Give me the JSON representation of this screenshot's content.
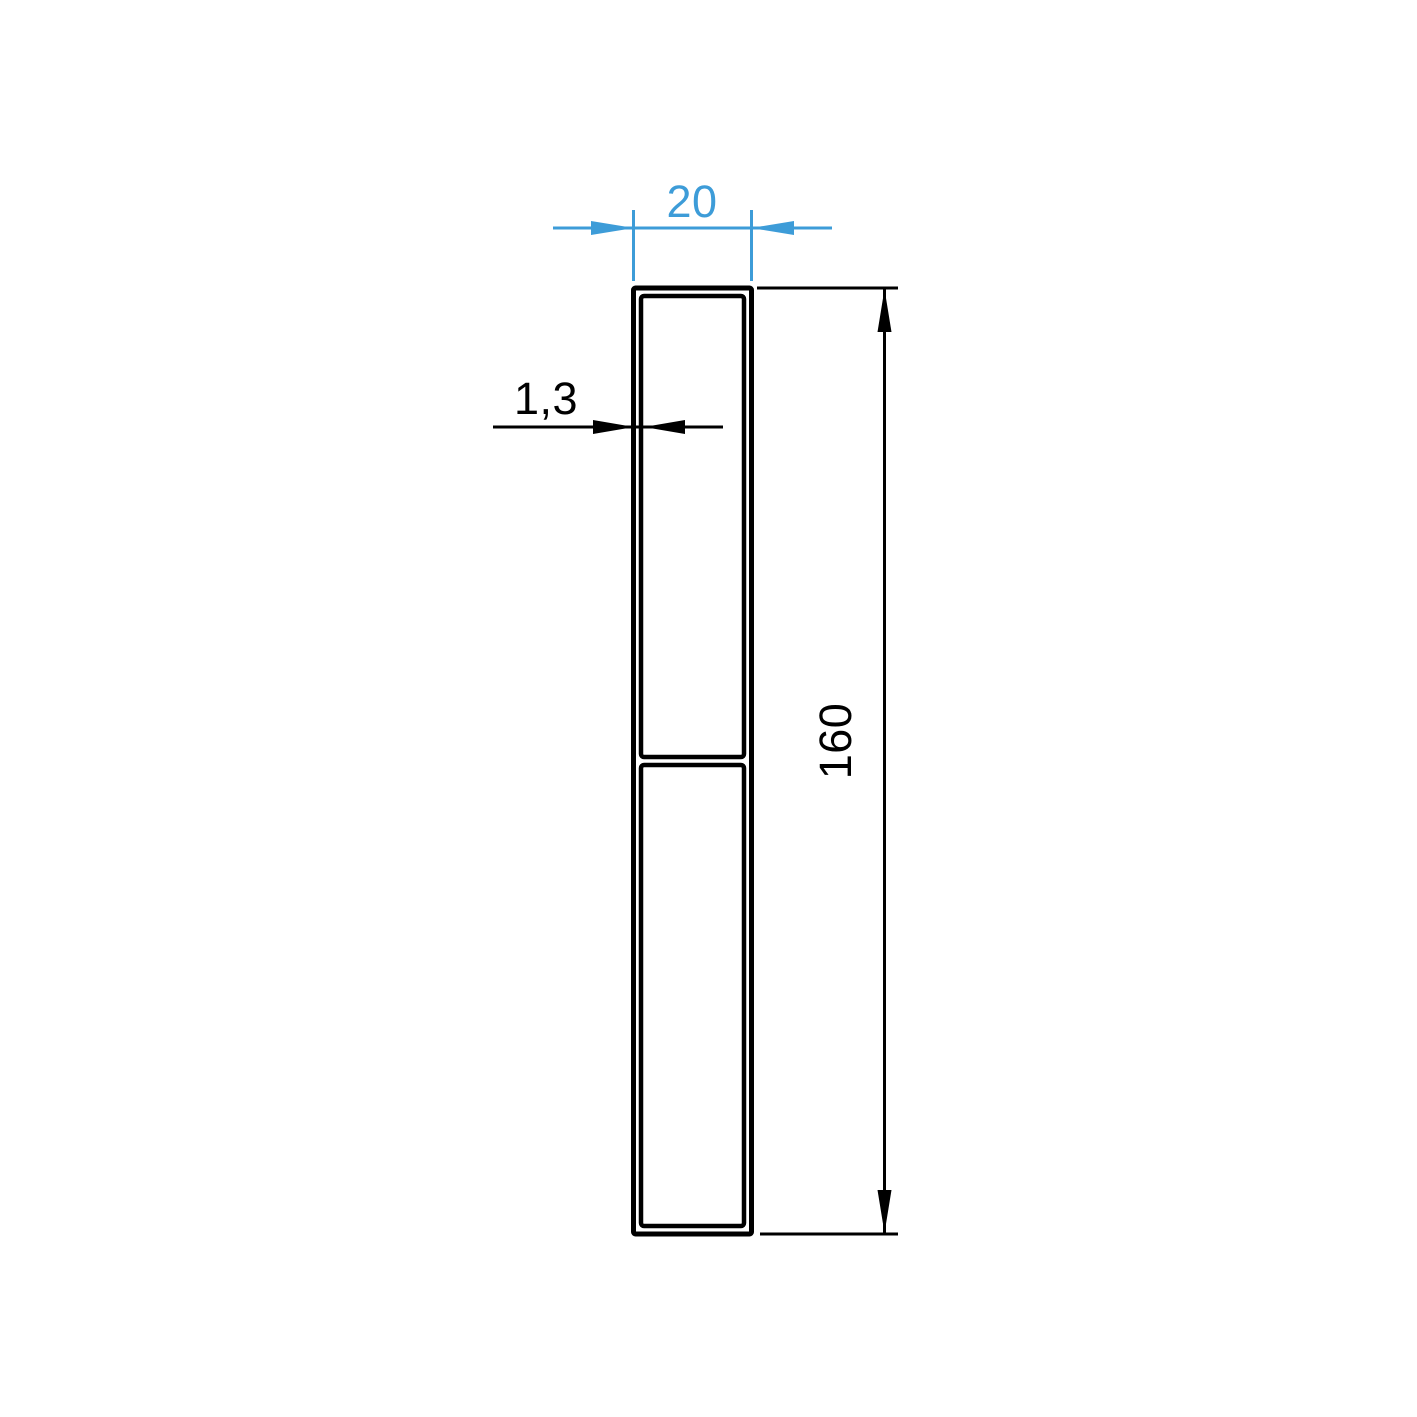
{
  "drawing": {
    "background": "#ffffff",
    "colors": {
      "accent": "#3d9cd8",
      "line": "#000000"
    },
    "labels": {
      "width": "20",
      "wall_thickness": "1,3",
      "height": "160"
    }
  }
}
